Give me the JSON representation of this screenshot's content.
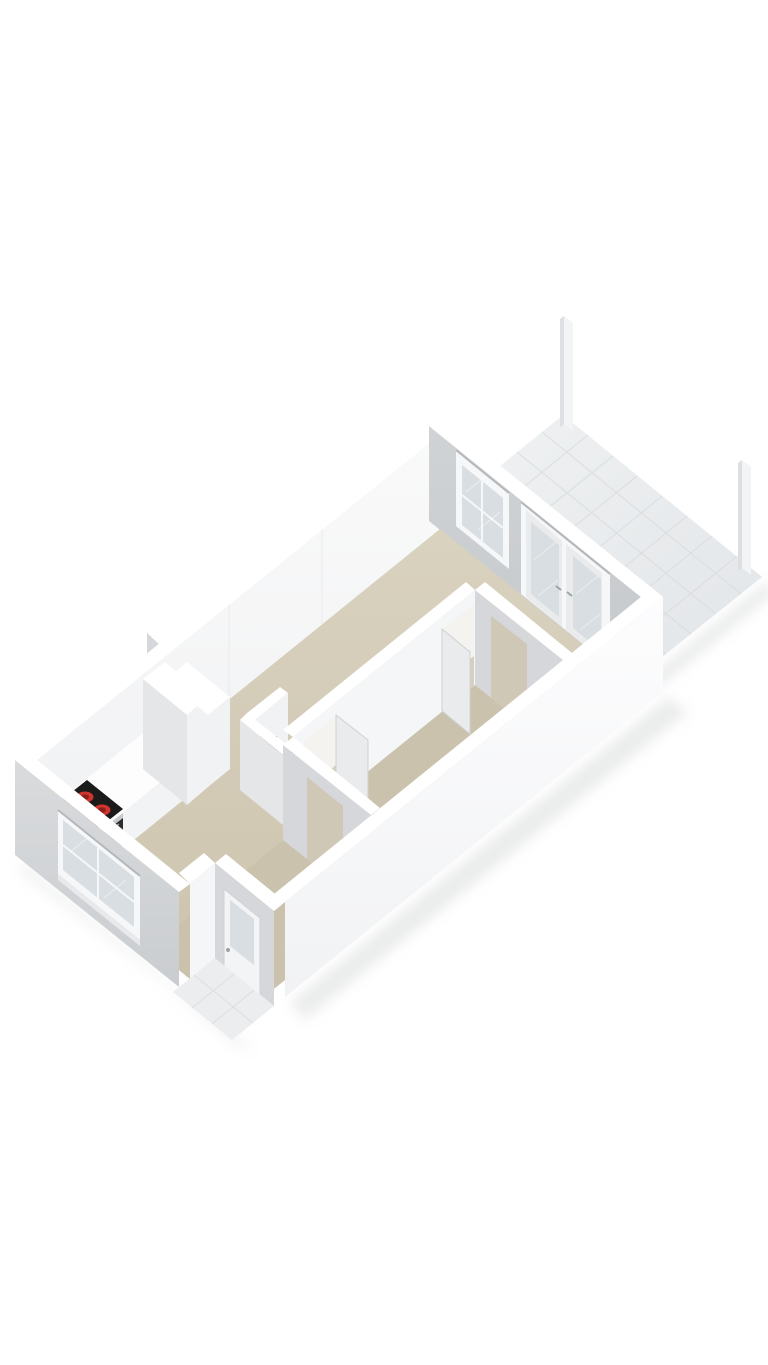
{
  "canvas": {
    "width": 768,
    "height": 1365,
    "background": "#ffffff"
  },
  "scene": {
    "colors": {
      "background": "#ffffff",
      "wall_top": "#ffffff",
      "wall_nw_ext": "#ededef",
      "wall_int_light_1": "#fafafa",
      "wall_int_light_2": "#f0f1f3",
      "wall_ne_1": "#d0d3d6",
      "wall_ne_2": "#c5c8cb",
      "wall_sw_1": "#d9dbdd",
      "wall_sw_2": "#cacdd0",
      "wall_se_1": "#fdfdfe",
      "wall_se_2": "#f1f2f4",
      "partition_face": "#f5f6f7",
      "partition_grey": "#d5d7da",
      "frame": "#f6f7f8",
      "glass": "#d9dee2",
      "reveal": "#b5b8bb",
      "streak": "#ffffff",
      "floor_1": "#d9d2bf",
      "floor_2": "#ccc3ad",
      "floor_hall": "#cbc2ad",
      "opening_far": "#f4f3f0",
      "opening_floor": "#d6cfbf",
      "doorway_fill": "#cfc8b6",
      "balcony_1": "#f0f2f3",
      "balcony_2": "#e2e5e8",
      "grout": "#d7dadc",
      "post_light": "#f2f4f5",
      "post_dark": "#dddfe2",
      "counter_top": "#fdfdfd",
      "counter_se": "#f2f3f4",
      "counter_sw": "#e8e9eb",
      "cab_top": "#ffffff",
      "cab_se": "#f1f2f3",
      "cab_sw": "#e5e6e8",
      "stove_top": "#1b1b1c",
      "burner": "#d0342e",
      "burner_inner": "#8c201c",
      "oven": "#2a2b2c",
      "steel": "#c7cacc",
      "handle": "#9fa3a5",
      "door_leaf": "#e9ebec",
      "door_edge": "#ced1d3",
      "door_white": "#f3f4f5",
      "utility_red": "#7b2522",
      "utility_red_top": "#a03430",
      "utility_black": "#1d1d1d",
      "stoop": "#ebedee",
      "stoop_grout": "#dcdee0",
      "seam": "#e9eaec",
      "shadow": "#9aa0a4"
    }
  }
}
